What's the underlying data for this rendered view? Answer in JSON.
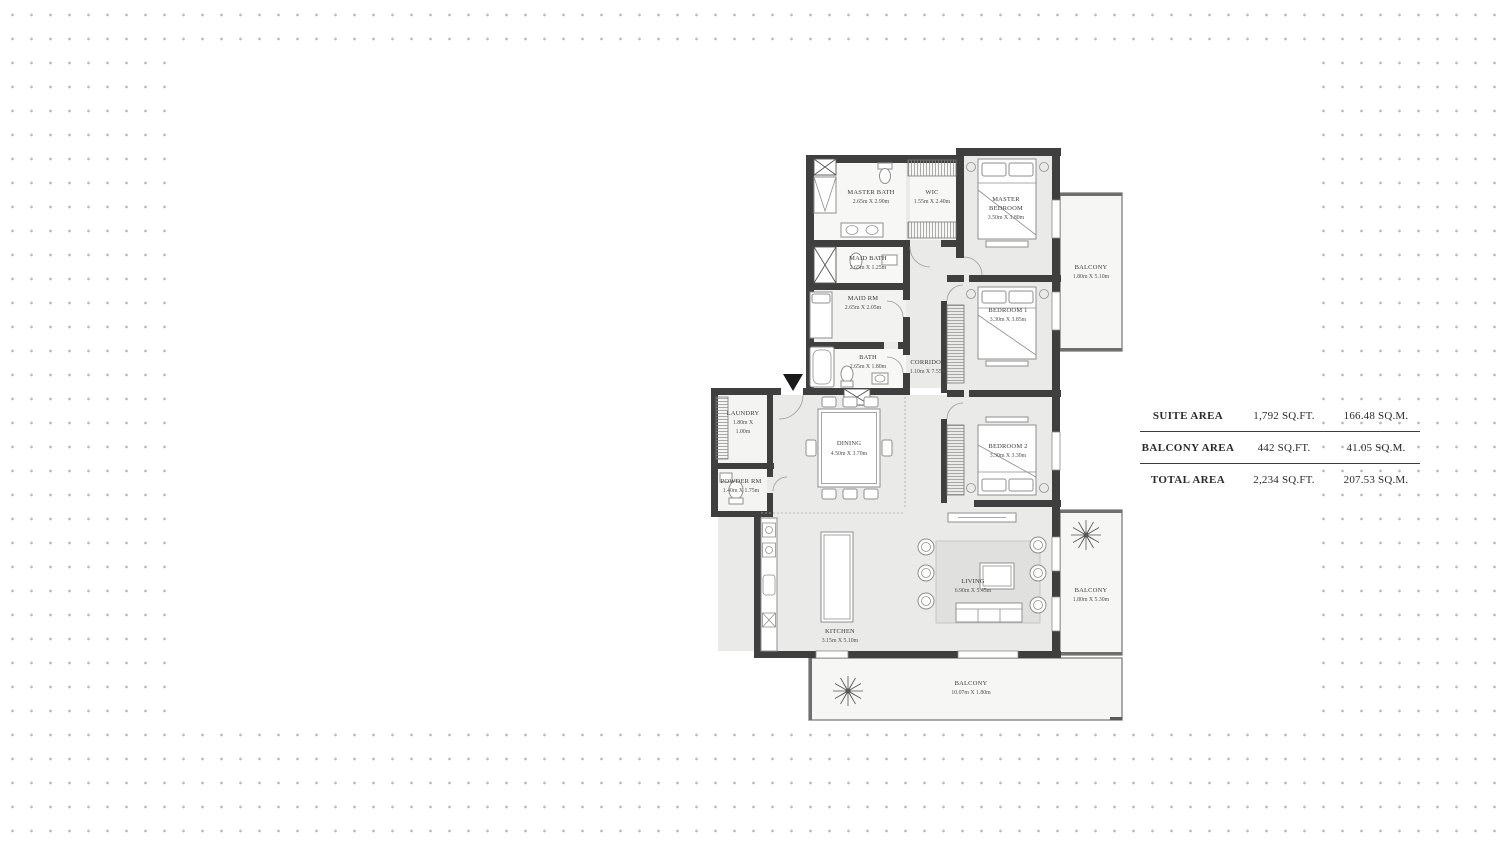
{
  "background": {
    "dot_color": "#b9b9b9",
    "canvas_color": "#ffffff",
    "wall_color": "#3f3f3f"
  },
  "floorplan": {
    "rooms": [
      {
        "name": "MASTER BATH",
        "dims": "2.65m X 2.90m"
      },
      {
        "name": "WIC",
        "dims": "1.55m X 2.40m"
      },
      {
        "name": "MAID BATH",
        "dims": "2.65m X 1.25m"
      },
      {
        "name": "MAID RM",
        "dims": "2.65m X 2.05m"
      },
      {
        "name": "BATH",
        "dims": "2.65m X 1.80m"
      },
      {
        "name": "CORRIDOR",
        "dims": "1.10m X 7.55m"
      },
      {
        "name": "MASTER",
        "name2": "BEDROOM",
        "dims": "3.50m X 3.80m"
      },
      {
        "name": "BEDROOM 1",
        "dims": "3.30m X 3.85m"
      },
      {
        "name": "BEDROOM 2",
        "dims": "3.30m X 3.30m"
      },
      {
        "name": "LAUNDRY",
        "dims": "1.80m X",
        "dims2": "1.00m"
      },
      {
        "name": "POWDER RM",
        "dims": "1.40m X 1.75m"
      },
      {
        "name": "DINING",
        "dims": "4.50m X 3.70m"
      },
      {
        "name": "KITCHEN",
        "dims": "3.15m X 5.10m"
      },
      {
        "name": "LIVING",
        "dims": "6.90m X 5.45m"
      },
      {
        "name": "BALCONY",
        "dims": "1.80m X 5.10m"
      },
      {
        "name": "BALCONY",
        "dims": "1.80m X 5.30m"
      },
      {
        "name": "BALCONY",
        "dims": "10.07m X 1.80m"
      }
    ]
  },
  "area_table": {
    "rows": [
      {
        "label": "SUITE AREA",
        "sqft": "1,792 SQ.FT.",
        "sqm": "166.48 SQ.M."
      },
      {
        "label": "BALCONY AREA",
        "sqft": "442 SQ.FT.",
        "sqm": "41.05 SQ.M."
      },
      {
        "label": "TOTAL AREA",
        "sqft": "2,234 SQ.FT.",
        "sqm": "207.53 SQ.M."
      }
    ]
  }
}
